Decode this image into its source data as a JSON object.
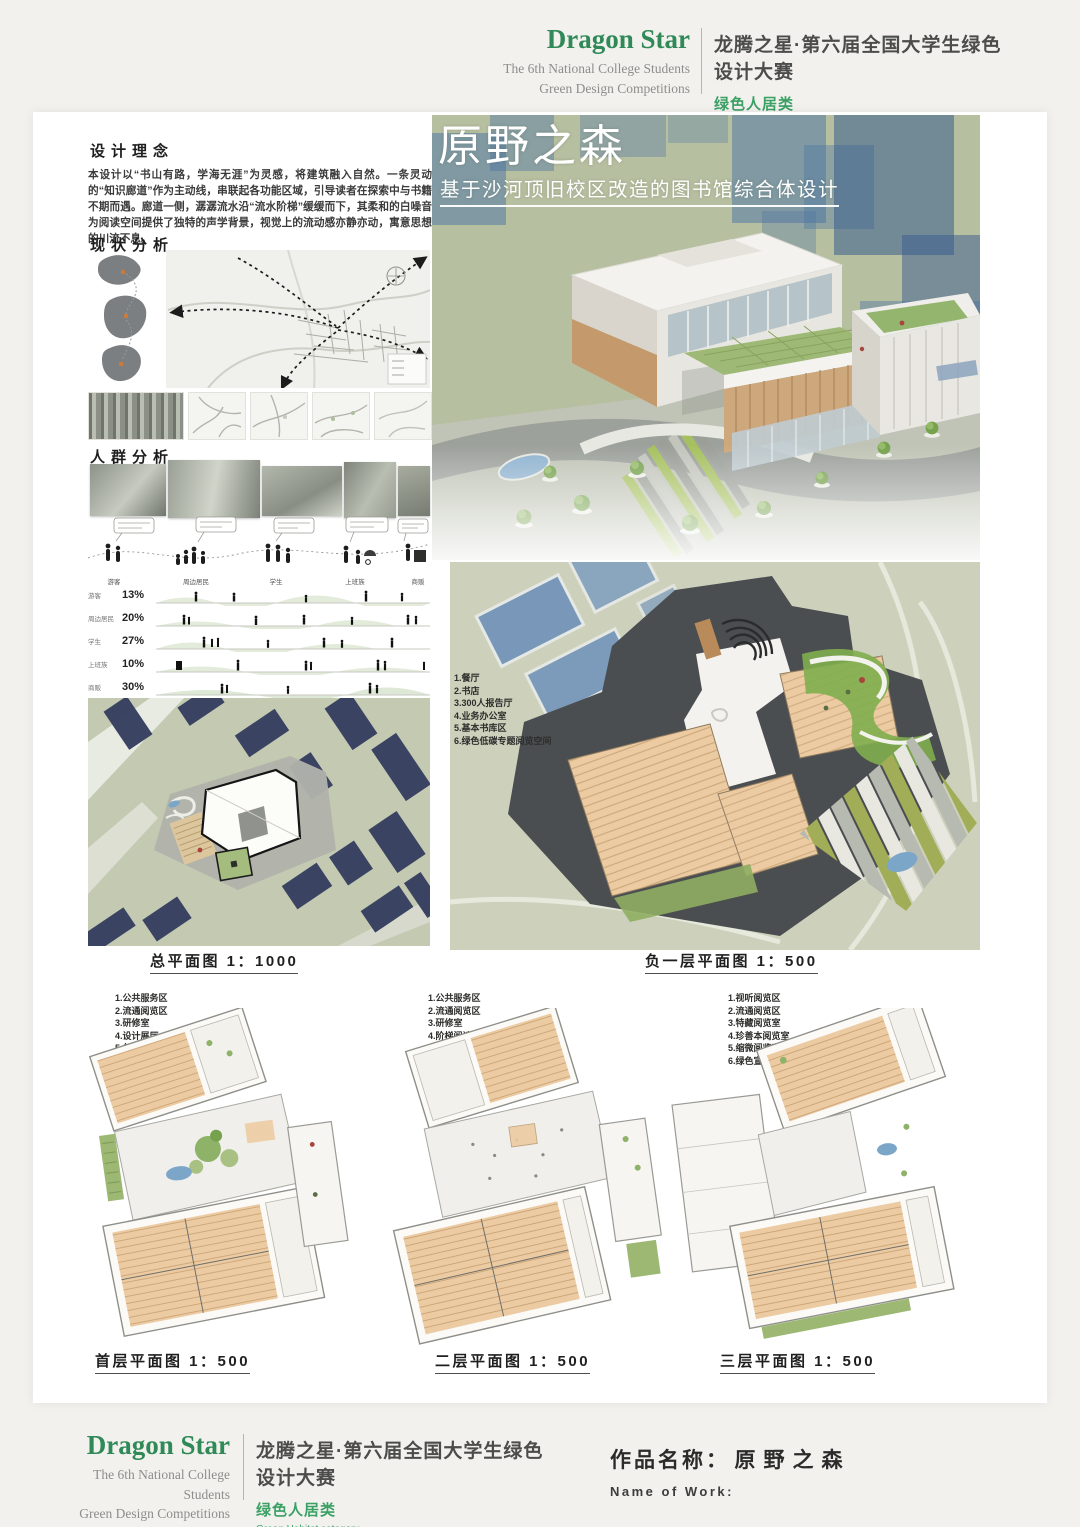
{
  "header": {
    "brand": "Dragon Star",
    "brand_sub1": "The 6th National College Students",
    "brand_sub2": "Green Design Competitions",
    "competition_title": "龙腾之星·第六届全国大学生绿色设计大赛",
    "category_cn": "绿色人居类",
    "category_en": "Green Habitat category"
  },
  "concept": {
    "heading": "设计理念",
    "body": "本设计以“书山有路，学海无涯”为灵感，将建筑融入自然。一条灵动的“知识廊道”作为主动线，串联起各功能区域，引导读者在探索中与书籍不期而遇。廊道一侧，潺潺流水沿“流水阶梯”缓缓而下，其柔和的白噪音为阅读空间提供了独特的声学背景，视觉上的流动感亦静亦动，寓意思想的川流不息。"
  },
  "status": {
    "heading": "现状分析"
  },
  "crowd": {
    "heading": "人群分析",
    "groups": [
      {
        "label": "游客",
        "pct": "13%"
      },
      {
        "label": "周边居民",
        "pct": "20%"
      },
      {
        "label": "学生",
        "pct": "27%"
      },
      {
        "label": "上班族",
        "pct": "10%"
      },
      {
        "label": "商贩",
        "pct": "30%"
      }
    ],
    "timeline_ticks": "0 1 2 3 4 5 6 7 8 9 10 11 12 13 14 15 16 17 18 19 20 21 22 23 24"
  },
  "hero": {
    "title": "原野之森",
    "subtitle": "基于沙河顶旧校区改造的图书馆综合体设计"
  },
  "site_plan": {
    "caption": "总平面图 1：1000"
  },
  "basement_plan": {
    "caption": "负一层平面图 1：500",
    "legend": [
      "1.餐厅",
      "2.书店",
      "3.300人报告厅",
      "4.业务办公室",
      "5.基本书库区",
      "6.绿色低碳专题阅览空间"
    ]
  },
  "floor1": {
    "caption": "首层平面图 1：500",
    "legend": [
      "1.公共服务区",
      "2.流通阅览区",
      "3.研修室",
      "4.设计展厅",
      "5.创客工作室",
      "6.绿色流水台阶"
    ]
  },
  "floor2": {
    "caption": "二层平面图 1：500",
    "legend": [
      "1.公共服务区",
      "2.流通阅览区",
      "3.研修室",
      "4.阶梯阅读角",
      "5.创客胶囊房",
      "6.绿色花园"
    ]
  },
  "floor3": {
    "caption": "三层平面图 1：500",
    "legend": [
      "1.视听阅览区",
      "2.流通阅览区",
      "3.特藏阅览室",
      "4.珍善本阅览室",
      "5.缩微阅览室",
      "6.绿色宣传展览"
    ]
  },
  "footer": {
    "work_label": "作品名称：",
    "work_value": "原野之森",
    "work_label_en": "Name of Work:"
  },
  "colors": {
    "brand_green": "#2f8a58",
    "category_green": "#3aa064",
    "sage": "#bfc5ab",
    "navy": "#333d60",
    "tan": "#edcda6",
    "charcoal": "#4b4e50"
  }
}
